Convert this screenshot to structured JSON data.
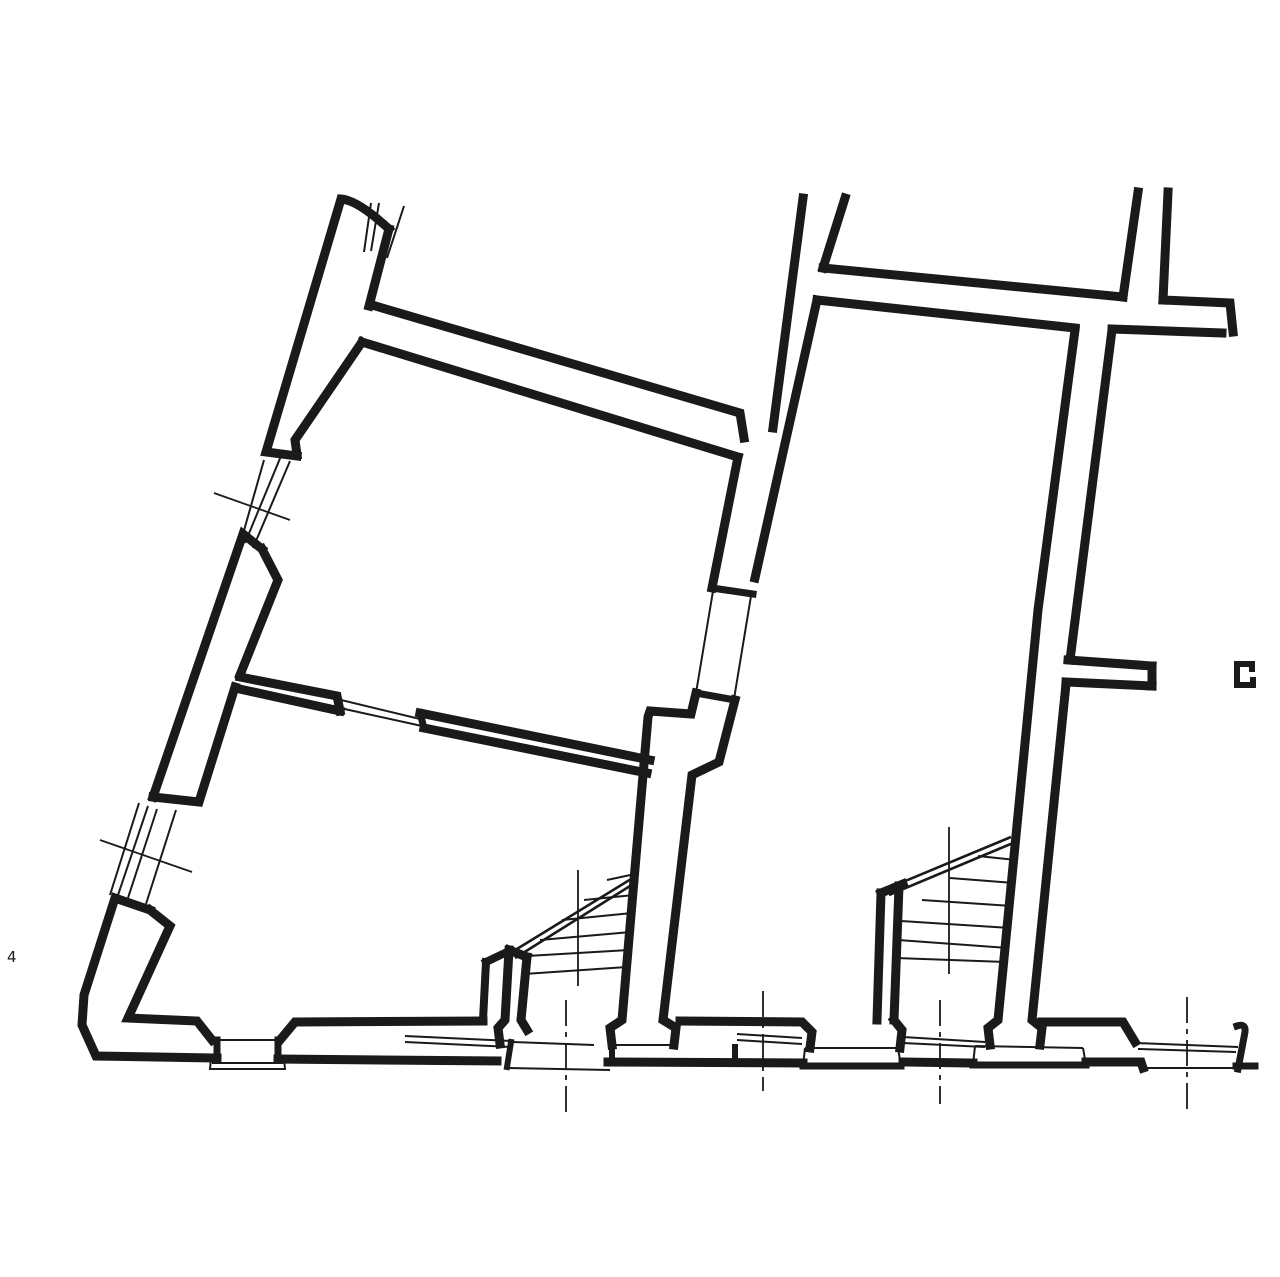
{
  "meta": {
    "description": "black-ink architectural floor plan, section through ground floor with two winder staircases",
    "canvas_width": 1280,
    "canvas_height": 1277,
    "background": "#ffffff",
    "ink": "#1a1a1a"
  },
  "labels": {
    "corner_mark": "4"
  },
  "drawing": {
    "groups": [
      {
        "name": "walls",
        "stroke_width": 9,
        "linecap": "square",
        "paths": [
          {
            "n": "left-wall-top-cap-and-outer-edge",
            "d": "M 389 229 Q 358 200 341 199 L 266 452 L 297 456"
          },
          {
            "n": "left-wall-inner-edge-upper",
            "d": "M 389 229 L 369 306"
          },
          {
            "n": "left-wall-inner-edge-mid",
            "d": "M 362 342 L 295 440 L 297 455"
          },
          {
            "n": "window1-bottom-jamb-and-outer-edge",
            "d": "M 262 549 L 243 534 L 153 797"
          },
          {
            "n": "left-wall-inner-splay",
            "d": "M 262 549 L 278 580 L 240 675"
          },
          {
            "n": "left-wall-inner-edge-lower-and-window2-top-jamb",
            "d": "M 235 687 L 199 802 L 153 797"
          },
          {
            "n": "window2-bottom-jamb-outer-corner-bottom-outer-edge",
            "d": "M 150 910 L 115 898 L 84 995 L 82 1025 L 96 1056 L 217 1058"
          },
          {
            "n": "left-wall-inner-splay2-corner-bottom-inner-edge",
            "d": "M 150 910 L 170 926 L 128 1018 L 197 1021 L 212 1040"
          },
          {
            "n": "footing1-left-side",
            "d": "M 217 1040 L 217 1058",
            "w": 7
          },
          {
            "n": "footing1-right-side",
            "d": "M 278 1040 L 278 1058",
            "w": 7
          },
          {
            "n": "bottom-inner-edge-2",
            "d": "M 280 1040 L 295 1022 L 483 1021"
          },
          {
            "n": "stair-plinth-left-edge",
            "d": "M 486 962 L 483 1020",
            "w": 8
          },
          {
            "n": "stair-plinth-top-cap",
            "d": "M 486 962 L 509 951",
            "w": 8
          },
          {
            "n": "left-stair-wall-outer",
            "d": "M 509 950 L 505 1020 L 498 1028 L 500 1044"
          },
          {
            "n": "left-stair-wall-inner",
            "d": "M 527 957 L 521 1020 L 527 1030"
          },
          {
            "n": "left-stair-wall-top-cap",
            "d": "M 509 950 L 527 957"
          },
          {
            "n": "bottom-outer-edge-2",
            "d": "M 278 1059 L 497 1061"
          },
          {
            "n": "footing2-left-side",
            "d": "M 511 1042 L 507 1067",
            "w": 6
          },
          {
            "n": "room-wall-c-top-edge-and-end-cap",
            "d": "M 372 305 L 740 413 L 744 438"
          },
          {
            "n": "room-wall-c-bottom-edge",
            "d": "M 362 342 L 738 457"
          },
          {
            "n": "middle-wall-left-edge-upper",
            "d": "M 803 198 L 773 428"
          },
          {
            "n": "middle-wall-left-edge-at-door",
            "d": "M 738 457 L 712 588"
          },
          {
            "n": "middle-door-top-jamb",
            "d": "M 712 588 L 753 594",
            "w": 7
          },
          {
            "n": "middle-door-bottom-jamb",
            "d": "M 696 693 L 735 700",
            "w": 7
          },
          {
            "n": "middle-wall-left-edge-lower-with-jog",
            "d": "M 696 693 L 691 714 L 650 711 L 648 717 L 622 1020 L 610 1028 L 612 1045"
          },
          {
            "n": "middle-wall-right-edge-upper",
            "d": "M 845 198 L 823 268"
          },
          {
            "n": "middle-wall-right-edge-mid",
            "d": "M 817 300 L 755 578"
          },
          {
            "n": "middle-wall-right-edge-lower-with-jog",
            "d": "M 735 700 L 719 762 L 692 775 L 663 1020 L 676 1028 L 674 1045"
          },
          {
            "n": "partition-wall-left-segment-top-and-cap",
            "d": "M 240 677 L 337 696 L 340 711"
          },
          {
            "n": "partition-wall-left-segment-bottom",
            "d": "M 235 688 L 340 711"
          },
          {
            "n": "partition-wall-right-segment-top",
            "d": "M 420 713 L 650 760"
          },
          {
            "n": "partition-wall-right-segment-cap",
            "d": "M 420 713 L 424 728",
            "w": 7
          },
          {
            "n": "partition-wall-right-segment-bottom",
            "d": "M 424 728 L 647 773"
          },
          {
            "n": "top-right-wall-top-edge-left-part",
            "d": "M 823 268 L 1123 297"
          },
          {
            "n": "top-right-wall-top-edge-right-part-and-cap",
            "d": "M 1163 300 L 1230 303 L 1233 332"
          },
          {
            "n": "top-right-wall-bottom-edge-right-part",
            "d": "M 1222 333 L 1112 329"
          },
          {
            "n": "top-right-wall-bottom-edge-left-part",
            "d": "M 1075 328 L 817 300"
          },
          {
            "n": "right-wall-left-edge-upper",
            "d": "M 1138 192 L 1123 297"
          },
          {
            "n": "right-wall-right-edge-upper",
            "d": "M 1168 192 L 1163 300"
          },
          {
            "n": "right-wall-left-edge-lower",
            "d": "M 1075 330 L 1038 610 L 998 1020 L 988 1028 L 990 1045"
          },
          {
            "n": "right-wall-right-edge-lower-a",
            "d": "M 1112 330 L 1070 660"
          },
          {
            "n": "stub-wall-top-edge",
            "d": "M 1068 660 L 1152 666"
          },
          {
            "n": "stub-wall-end-cap",
            "d": "M 1152 666 L 1152 686"
          },
          {
            "n": "stub-wall-bottom-edge",
            "d": "M 1066 682 L 1152 686"
          },
          {
            "n": "right-wall-right-edge-lower-b",
            "d": "M 1066 684 L 1032 1020 L 1042 1028 L 1040 1045"
          },
          {
            "n": "right-stair-wall-outer",
            "d": "M 881 893 L 877 1020"
          },
          {
            "n": "right-stair-wall-inner",
            "d": "M 899 886 L 894 1020"
          },
          {
            "n": "right-stair-wall-top-cap",
            "d": "M 881 893 L 903 884"
          },
          {
            "n": "bottom-inner-edge-3",
            "d": "M 680 1021 L 802 1022 L 812 1032 L 810 1048"
          },
          {
            "n": "footing4-right-flare",
            "d": "M 894 1020 L 902 1030 L 900 1048"
          },
          {
            "n": "footing4-bottom",
            "d": "M 803 1066 L 901 1066",
            "w": 7
          },
          {
            "n": "bottom-outer-edge-3",
            "d": "M 608 1062 L 803 1063"
          },
          {
            "n": "bottom-outer-edge-4",
            "d": "M 903 1062 L 973 1063"
          },
          {
            "n": "footing5-bottom",
            "d": "M 973 1065 L 1086 1065",
            "w": 7
          },
          {
            "n": "bottom-outer-edge-5",
            "d": "M 1086 1062 L 1141 1062 L 1143 1068"
          },
          {
            "n": "bottom-inner-edge-4-with-step",
            "d": "M 1042 1022 L 1123 1022 L 1135 1042"
          },
          {
            "n": "footing3-left-side",
            "d": "M 612 1045 L 612 1062",
            "w": 6
          },
          {
            "n": "footing3-right-side",
            "d": "M 735 1062 L 735 1047",
            "w": 6
          },
          {
            "n": "bottom-right-hook-wall",
            "d": "M 1238 1069 L 1245 1032 Q 1246 1023 1237 1026",
            "w": 7
          },
          {
            "n": "bottom-right-end-bar",
            "d": "M 1236 1066 L 1255 1066",
            "w": 7
          },
          {
            "n": "c-shaped-wall-fragment",
            "d": "M 1253 680 L 1253 685 L 1237 685 L 1237 664 L 1252 664 L 1252 669",
            "w": 6
          }
        ]
      },
      {
        "name": "thin-lines",
        "stroke_width": 2,
        "linecap": "butt",
        "paths": [
          {
            "n": "window1-outer-face",
            "d": "M 264 460 L 243 534"
          },
          {
            "n": "window1-frame-line-a",
            "d": "M 281 456 L 245 543"
          },
          {
            "n": "window1-frame-line-b",
            "d": "M 290 461 L 253 548"
          },
          {
            "n": "window2-outer-face",
            "d": "M 139 803 L 110 895"
          },
          {
            "n": "window2-frame-line-a",
            "d": "M 148 806 L 117 898"
          },
          {
            "n": "window2-frame-line-b",
            "d": "M 157 809 L 127 901"
          },
          {
            "n": "window2-frame-line-c",
            "d": "M 176 810 L 146 904"
          },
          {
            "n": "wall-continuation-line-a",
            "d": "M 371 203 L 364 252"
          },
          {
            "n": "wall-continuation-line-b",
            "d": "M 379 203 L 371 251"
          },
          {
            "n": "wall-continuation-line-c",
            "d": "M 404 206 L 387 258"
          },
          {
            "n": "partition-door-line-a",
            "d": "M 337 699 L 420 719"
          },
          {
            "n": "partition-door-line-b",
            "d": "M 340 708 L 422 726"
          },
          {
            "n": "middle-door-line-a",
            "d": "M 713 591 L 696 693"
          },
          {
            "n": "middle-door-line-b",
            "d": "M 751 596 L 734 699"
          },
          {
            "n": "footing1-top-line",
            "d": "M 213 1040 L 280 1040"
          },
          {
            "n": "footing1-base-outline",
            "d": "M 211 1058 L 210 1069 L 285 1069 L 284 1058"
          },
          {
            "n": "footing1-base-midline",
            "d": "M 212 1063 L 283 1063"
          },
          {
            "n": "footing2-top-line",
            "d": "M 513 1042 L 594 1045"
          },
          {
            "n": "footing2-base-line",
            "d": "M 506 1068 L 610 1070"
          },
          {
            "n": "footing3-top-line",
            "d": "M 614 1045 L 672 1045"
          },
          {
            "n": "footing4-top-line",
            "d": "M 805 1048 L 898 1048"
          },
          {
            "n": "footing4-side-lines",
            "d": "M 805 1048 L 803 1066 M 898 1048 L 901 1066"
          },
          {
            "n": "footing5-top-line",
            "d": "M 975 1046 L 1083 1048"
          },
          {
            "n": "footing5-side-lines",
            "d": "M 975 1046 L 973 1065 M 1083 1048 L 1086 1065"
          },
          {
            "n": "footing6-base-line",
            "d": "M 1143 1068 L 1237 1068"
          },
          {
            "n": "plinth-ledge-double-line",
            "d": "M 405 1036 L 512 1041 M 405 1042 L 512 1047"
          },
          {
            "n": "ledge-double-line-mid",
            "d": "M 737 1034 L 802 1038 M 737 1040 L 802 1044"
          },
          {
            "n": "ledge-double-line-right-stair",
            "d": "M 903 1037 L 985 1042 M 903 1043 L 985 1047"
          },
          {
            "n": "ledge-double-line-right-end",
            "d": "M 1135 1043 L 1238 1047 M 1138 1049 L 1236 1052"
          },
          {
            "n": "left-stair-steps",
            "d": "M 607 880 L 635 874 M 584 900 L 634 895 M 562 920 L 632 913 M 540 940 L 631 932 M 527 956 L 629 950 M 524 974 L 627 967"
          },
          {
            "n": "right-stair-steps",
            "d": "M 978 856 L 1016 860 M 950 878 L 1014 883 M 922 900 L 1012 906 M 901 921 L 1010 928 M 898 940 L 1008 948 M 896 958 L 1006 962"
          }
        ]
      },
      {
        "name": "stair-stringers",
        "stroke_width": 2.6,
        "linecap": "butt",
        "paths": [
          {
            "n": "left-stair-stringer-double-line",
            "d": "M 512 952 L 636 876 M 515 958 L 638 881"
          },
          {
            "n": "right-stair-stringer-double-line",
            "d": "M 886 889 L 1011 837 M 889 895 L 1013 843"
          }
        ]
      },
      {
        "name": "axis-marks",
        "stroke_width": 1.8,
        "linecap": "butt",
        "paths": [
          {
            "n": "window1-axis-slash",
            "d": "M 214 493 L 290 520"
          },
          {
            "n": "window2-axis-slash",
            "d": "M 100 840 L 192 872"
          },
          {
            "n": "left-stair-axis-line-upper",
            "d": "M 578 870 L 578 986"
          },
          {
            "n": "left-stair-axis-line-lower",
            "d": "M 566 1000 L 566 1113",
            "dash": true
          },
          {
            "n": "middle-footing-axis-line",
            "d": "M 763 991 L 763 1091",
            "dash": true
          },
          {
            "n": "right-stair-axis-line-upper",
            "d": "M 949 827 L 949 974"
          },
          {
            "n": "right-stair-axis-line-lower",
            "d": "M 940 1000 L 940 1104",
            "dash": true
          },
          {
            "n": "right-end-axis-line",
            "d": "M 1187 997 L 1187 1114",
            "dash": true
          }
        ]
      }
    ]
  }
}
